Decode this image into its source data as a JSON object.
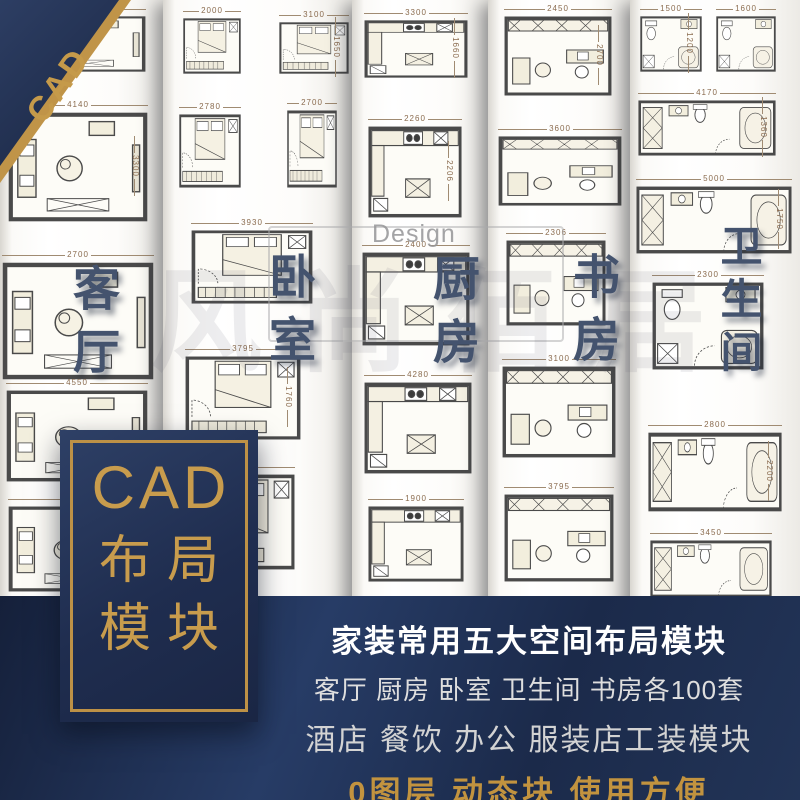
{
  "colors": {
    "navy": "#1f2d50",
    "navy_dark": "#17223c",
    "gold": "#c2954a",
    "label_blue": "#44536e",
    "paper": "#ffffff",
    "dim_text": "#8a6b4e",
    "banner_white": "#ffffff"
  },
  "corner_badge": {
    "label": "CAD"
  },
  "title_box": {
    "line1": "CAD",
    "line2": "布局",
    "line3": "模块"
  },
  "banner": {
    "line1": "家装常用五大空间布局模块",
    "line2": "客厅 厨房 卧室 卫生间 书房各100套",
    "line3": "酒店 餐饮 办公 服装店工装模块",
    "line4": "0图层 动态块 使用方便"
  },
  "watermark": {
    "brand": "Design",
    "chars": "风尚佰居"
  },
  "columns": [
    {
      "room": "客厅",
      "type": "living",
      "tiles": [
        {
          "dim": "3300"
        },
        {
          "dim": "4140",
          "side": "3300"
        },
        {
          "dim": "2700"
        },
        {
          "dim": "4550"
        },
        {
          "dim": "3900"
        }
      ]
    },
    {
      "room": "卧室",
      "type": "bedroom",
      "tiles": [
        {
          "dim": "2000"
        },
        {
          "dim": "3100",
          "side": "1650"
        },
        {
          "dim": "2780"
        },
        {
          "dim": "2700"
        },
        {
          "dim": "3930"
        },
        {
          "dim": "3795",
          "side": "1760"
        },
        {
          "dim": "1908"
        }
      ]
    },
    {
      "room": "厨房",
      "type": "kitchen",
      "tiles": [
        {
          "dim": "3300",
          "side": "1660"
        },
        {
          "dim": "2260",
          "side": "2206"
        },
        {
          "dim": "2400"
        },
        {
          "dim": "4280"
        },
        {
          "dim": "1900"
        }
      ]
    },
    {
      "room": "书房",
      "type": "study",
      "tiles": [
        {
          "dim": "2450",
          "side": "2700"
        },
        {
          "dim": "3600"
        },
        {
          "dim": "2306"
        },
        {
          "dim": "3100"
        },
        {
          "dim": "3795"
        }
      ]
    },
    {
      "room": "卫生间",
      "type": "bathroom",
      "tiles": [
        {
          "dim": "1500",
          "side": "1200"
        },
        {
          "dim": "1600"
        },
        {
          "dim": "4170",
          "side": "1360"
        },
        {
          "dim": "5000",
          "side": "1750"
        },
        {
          "dim": "2300"
        },
        {
          "dim": "2800",
          "side": "2200"
        },
        {
          "dim": "3450"
        }
      ]
    }
  ]
}
